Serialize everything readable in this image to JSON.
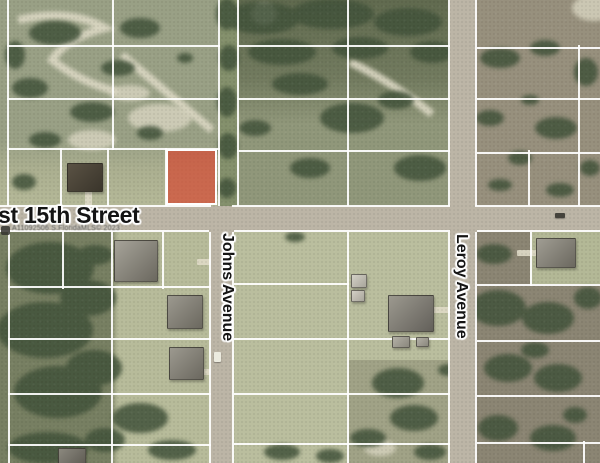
{
  "map": {
    "labels": {
      "street": "st 15th Street",
      "avenue1": "Johns Avenue",
      "avenue2": "Leroy Avenue",
      "watermark": "A11092506 S.FloridaMLS© 2023"
    },
    "colors": {
      "highlight_fill": "rgba(215,66,42,0.66)",
      "road": "#bcb5a6",
      "parcel_line": "#ffffff",
      "lawn": "#b8bc9b",
      "scrub": "#8b8573",
      "woods": "#44543a",
      "sand": "#d9d5c1"
    },
    "highlight_parcel": {
      "x": 166,
      "y": 149,
      "w": 47,
      "h": 52
    },
    "roads": [
      {
        "id": "street-15th",
        "x": 0,
        "y": 206,
        "w": 600,
        "h": 26
      },
      {
        "id": "johns-avenue",
        "x": 211,
        "y": 230,
        "w": 21,
        "h": 233
      },
      {
        "id": "leroy-avenue",
        "x": 450,
        "y": 0,
        "w": 25,
        "h": 463
      }
    ],
    "parcel_lines": [
      {
        "x": 7,
        "y": 0,
        "w": 2,
        "h": 206
      },
      {
        "x": 112,
        "y": 0,
        "w": 2,
        "h": 150
      },
      {
        "x": 60,
        "y": 148,
        "w": 2,
        "h": 58
      },
      {
        "x": 107,
        "y": 148,
        "w": 2,
        "h": 58
      },
      {
        "x": 165,
        "y": 148,
        "w": 2,
        "h": 58
      },
      {
        "x": 218,
        "y": 0,
        "w": 2,
        "h": 206
      },
      {
        "x": 237,
        "y": 0,
        "w": 2,
        "h": 206
      },
      {
        "x": 347,
        "y": 0,
        "w": 2,
        "h": 206
      },
      {
        "x": 578,
        "y": 45,
        "w": 2,
        "h": 161
      },
      {
        "x": 528,
        "y": 150,
        "w": 2,
        "h": 56
      },
      {
        "x": 448,
        "y": 0,
        "w": 2,
        "h": 206
      },
      {
        "x": 475,
        "y": 0,
        "w": 2,
        "h": 206
      },
      {
        "x": 448,
        "y": 232,
        "w": 2,
        "h": 231
      },
      {
        "x": 475,
        "y": 232,
        "w": 2,
        "h": 231
      },
      {
        "x": 209,
        "y": 232,
        "w": 2,
        "h": 231
      },
      {
        "x": 232,
        "y": 232,
        "w": 2,
        "h": 231
      },
      {
        "x": 8,
        "y": 232,
        "w": 2,
        "h": 231
      },
      {
        "x": 62,
        "y": 232,
        "w": 2,
        "h": 57
      },
      {
        "x": 111,
        "y": 232,
        "w": 2,
        "h": 231
      },
      {
        "x": 162,
        "y": 232,
        "w": 2,
        "h": 57
      },
      {
        "x": 347,
        "y": 232,
        "w": 2,
        "h": 231
      },
      {
        "x": 530,
        "y": 232,
        "w": 2,
        "h": 54
      },
      {
        "x": 583,
        "y": 441,
        "w": 2,
        "h": 22
      },
      {
        "x": 7,
        "y": 45,
        "w": 213,
        "h": 2
      },
      {
        "x": 237,
        "y": 45,
        "w": 213,
        "h": 2
      },
      {
        "x": 477,
        "y": 47,
        "w": 123,
        "h": 2
      },
      {
        "x": 7,
        "y": 98,
        "w": 213,
        "h": 2
      },
      {
        "x": 237,
        "y": 98,
        "w": 213,
        "h": 2
      },
      {
        "x": 477,
        "y": 98,
        "w": 123,
        "h": 2
      },
      {
        "x": 7,
        "y": 148,
        "w": 213,
        "h": 2
      },
      {
        "x": 237,
        "y": 150,
        "w": 213,
        "h": 2
      },
      {
        "x": 477,
        "y": 152,
        "w": 123,
        "h": 2
      },
      {
        "x": 0,
        "y": 205,
        "w": 211,
        "h": 2
      },
      {
        "x": 232,
        "y": 205,
        "w": 218,
        "h": 2
      },
      {
        "x": 475,
        "y": 205,
        "w": 125,
        "h": 2
      },
      {
        "x": 0,
        "y": 230,
        "w": 209,
        "h": 2
      },
      {
        "x": 234,
        "y": 230,
        "w": 216,
        "h": 2
      },
      {
        "x": 477,
        "y": 230,
        "w": 123,
        "h": 2
      },
      {
        "x": 8,
        "y": 286,
        "w": 203,
        "h": 2
      },
      {
        "x": 234,
        "y": 283,
        "w": 115,
        "h": 2
      },
      {
        "x": 477,
        "y": 284,
        "w": 123,
        "h": 2
      },
      {
        "x": 8,
        "y": 338,
        "w": 203,
        "h": 2
      },
      {
        "x": 234,
        "y": 338,
        "w": 216,
        "h": 2
      },
      {
        "x": 477,
        "y": 340,
        "w": 123,
        "h": 2
      },
      {
        "x": 8,
        "y": 393,
        "w": 203,
        "h": 2
      },
      {
        "x": 234,
        "y": 393,
        "w": 216,
        "h": 2
      },
      {
        "x": 477,
        "y": 395,
        "w": 123,
        "h": 2
      },
      {
        "x": 8,
        "y": 444,
        "w": 203,
        "h": 2
      },
      {
        "x": 234,
        "y": 443,
        "w": 216,
        "h": 2
      },
      {
        "x": 477,
        "y": 442,
        "w": 123,
        "h": 2
      }
    ],
    "houses": [
      {
        "x": 67,
        "y": 163,
        "w": 34,
        "h": 27,
        "c1": "#5a5244",
        "c2": "#3a352b"
      },
      {
        "x": 114,
        "y": 240,
        "w": 42,
        "h": 40,
        "c1": "#a6a399",
        "c2": "#6b685f"
      },
      {
        "x": 167,
        "y": 295,
        "w": 34,
        "h": 32,
        "c1": "#9c998f",
        "c2": "#6b685f"
      },
      {
        "x": 169,
        "y": 347,
        "w": 33,
        "h": 31,
        "c1": "#9c998f",
        "c2": "#6b685f"
      },
      {
        "x": 58,
        "y": 448,
        "w": 26,
        "h": 15,
        "c1": "#8b887e",
        "c2": "#5f5c54"
      },
      {
        "x": 388,
        "y": 295,
        "w": 44,
        "h": 35,
        "c1": "#9c998f",
        "c2": "#63605a"
      },
      {
        "x": 536,
        "y": 238,
        "w": 38,
        "h": 28,
        "c1": "#a09d93",
        "c2": "#6b685f"
      },
      {
        "x": 351,
        "y": 274,
        "w": 14,
        "h": 12,
        "c1": "#d3d0c6",
        "c2": "#a8a59b",
        "t": "shed"
      },
      {
        "x": 351,
        "y": 290,
        "w": 12,
        "h": 10,
        "c1": "#d3d0c6",
        "c2": "#a8a59b",
        "t": "shed"
      },
      {
        "x": 392,
        "y": 336,
        "w": 16,
        "h": 10,
        "c1": "#b3b0a6",
        "c2": "#8a877d",
        "t": "shed"
      },
      {
        "x": 416,
        "y": 337,
        "w": 11,
        "h": 8,
        "c1": "#b3b0a6",
        "c2": "#8a877d",
        "t": "shed"
      }
    ],
    "driveways": [
      {
        "x": 85,
        "y": 189,
        "w": 7,
        "h": 18
      },
      {
        "x": 197,
        "y": 259,
        "w": 14,
        "h": 6
      },
      {
        "x": 199,
        "y": 369,
        "w": 12,
        "h": 6
      },
      {
        "x": 430,
        "y": 307,
        "w": 20,
        "h": 6
      },
      {
        "x": 517,
        "y": 250,
        "w": 21,
        "h": 6
      }
    ],
    "vehicles": [
      {
        "x": 555,
        "y": 213,
        "w": 10,
        "h": 5,
        "c": "#45433c"
      },
      {
        "x": 214,
        "y": 352,
        "w": 7,
        "h": 10,
        "c": "#ecebdf"
      }
    ]
  }
}
